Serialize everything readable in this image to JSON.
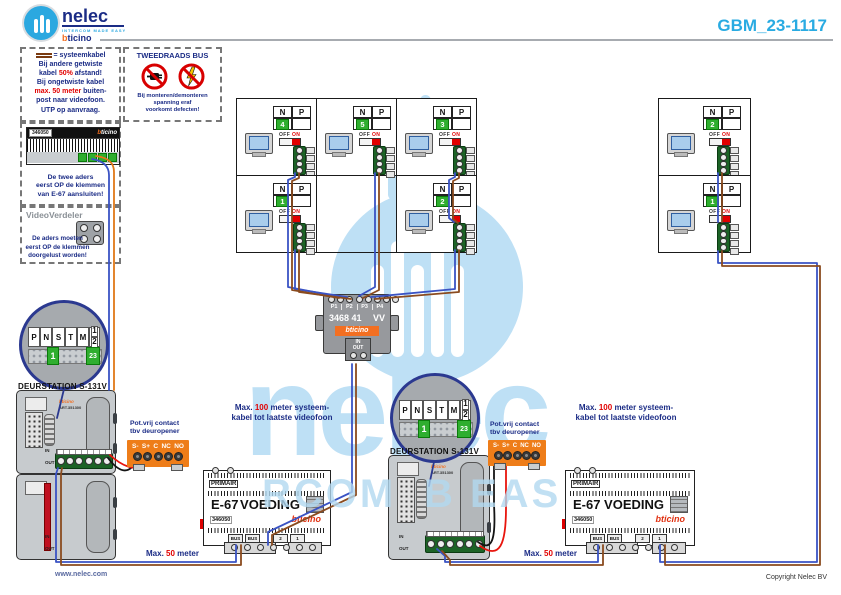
{
  "header": {
    "brand": "nelec",
    "tagline": "INTERCOM MADE EASY",
    "sub_b": "b",
    "sub_rest": "ticino",
    "code": "GBM_23-1117"
  },
  "legend": {
    "eq": "= systeemkabel",
    "l1": "Bij andere getwiste",
    "l2a": "kabel ",
    "l2b": "50%",
    "l2c": " afstand!",
    "l3": "Bij ongetwiste kabel",
    "l4a": "max. 50 meter",
    "l4b": " buiten-",
    "l5": "post naar videofoon.",
    "l6": "UTP op aanvraag."
  },
  "bus_note": {
    "title": "TWEEDRAADS BUS",
    "c1": "Bij monteren/demonteren",
    "c2": "spanning eraf",
    "c3": "voorkomt defecten!"
  },
  "splice_note": {
    "device": "346050",
    "brand_b": "b",
    "brand_rest": "ticino",
    "c1": "De twee aders",
    "c2": "eerst OP de klemmen",
    "c3": "van E-67 aansluiten!"
  },
  "verdeler_note": {
    "title": "VideoVerdeler",
    "c1": "De aders moeten",
    "c2": "eerst OP de klemmen",
    "c3": "doorgelust worden!"
  },
  "phone": {
    "n": "N",
    "p": "P",
    "off": "OFF",
    "on": "ON"
  },
  "phone_numbers": {
    "a": "4",
    "b": "5",
    "c": "3",
    "d": "1",
    "e": "2",
    "f": "2",
    "g": "1"
  },
  "hub": {
    "p1": "P1",
    "p2": "P2",
    "p3": "P3",
    "p4": "P4",
    "model": "3468 41",
    "vv": "VV",
    "brand": "bticino",
    "in": "IN",
    "out": "OUT"
  },
  "dip": {
    "p": "P",
    "n": "N",
    "s": "S",
    "t": "T",
    "m": "M",
    "one": "1",
    "two": "2",
    "val": "1",
    "val2": "23"
  },
  "door": {
    "title": "DEURSTATION S-131V",
    "brand": "bticino",
    "art": "ART.351300",
    "in": "IN",
    "out": "OUT"
  },
  "contact": {
    "l1": "Pot.vrij contact",
    "l2": "tbv deuropener",
    "t1": "S-",
    "t2": "S+",
    "t3": "C",
    "t4": "NC",
    "t5": "NO"
  },
  "psu": {
    "primair": "PRIMAIR",
    "model": "E-67",
    "type": "VOEDING",
    "art": "346050",
    "brand": "bticino",
    "b1": "BUS",
    "b2": "BUS",
    "t3": "2",
    "t4": "1"
  },
  "max100": {
    "a": "Max. ",
    "b": "100",
    "c": " meter systeem-",
    "d": "kabel tot laatste videofoon"
  },
  "max50": {
    "a": "Max. ",
    "b": "50",
    "c": " meter"
  },
  "watermark": {
    "word": "nelec",
    "p1": "RCOM",
    "p2": "B EAS"
  },
  "footer": {
    "left": "www.nelec.com",
    "right": "Copyright Nelec BV"
  }
}
